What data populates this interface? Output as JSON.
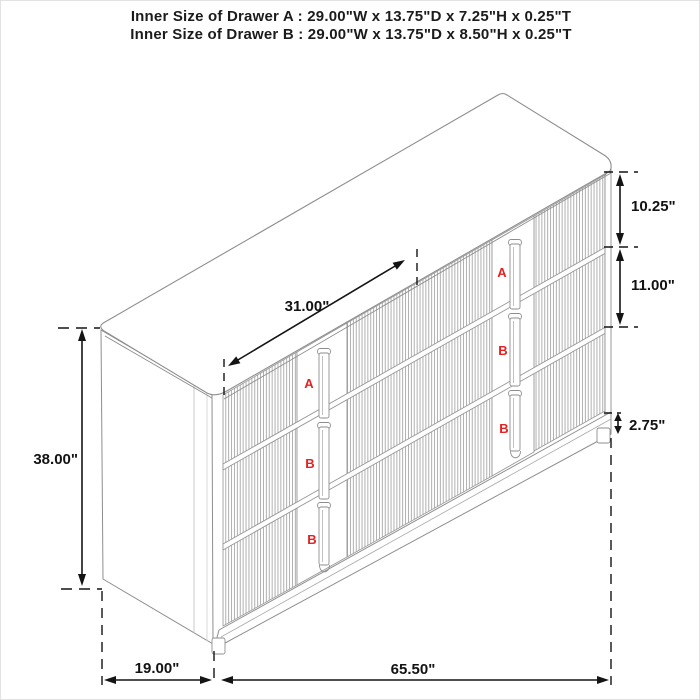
{
  "header": {
    "line1": "Inner Size of Drawer A : 29.00\"W x 13.75\"D x 7.25\"H x 0.25\"T",
    "line2": "Inner Size of Drawer B : 29.00\"W x 13.75\"D x 8.50\"H x 0.25\"T"
  },
  "diagram": {
    "subject": "three-drawer fluted sideboard, three-quarter perspective line drawing",
    "dimensions": {
      "top_diagonal_width": "31.00\"",
      "overall_height": "38.00\"",
      "drawer_a_face_height": "10.25\"",
      "drawer_b_face_height": "11.00\"",
      "base_height": "2.75\"",
      "depth": "19.00\"",
      "width": "65.50\""
    },
    "drawer_labels": [
      "A",
      "B",
      "B",
      "A",
      "B",
      "B"
    ],
    "colors": {
      "sketch_line": "#8e8e8e",
      "dimension_line": "#141414",
      "drawer_label_red": "#e32222",
      "background": "#ffffff"
    }
  }
}
